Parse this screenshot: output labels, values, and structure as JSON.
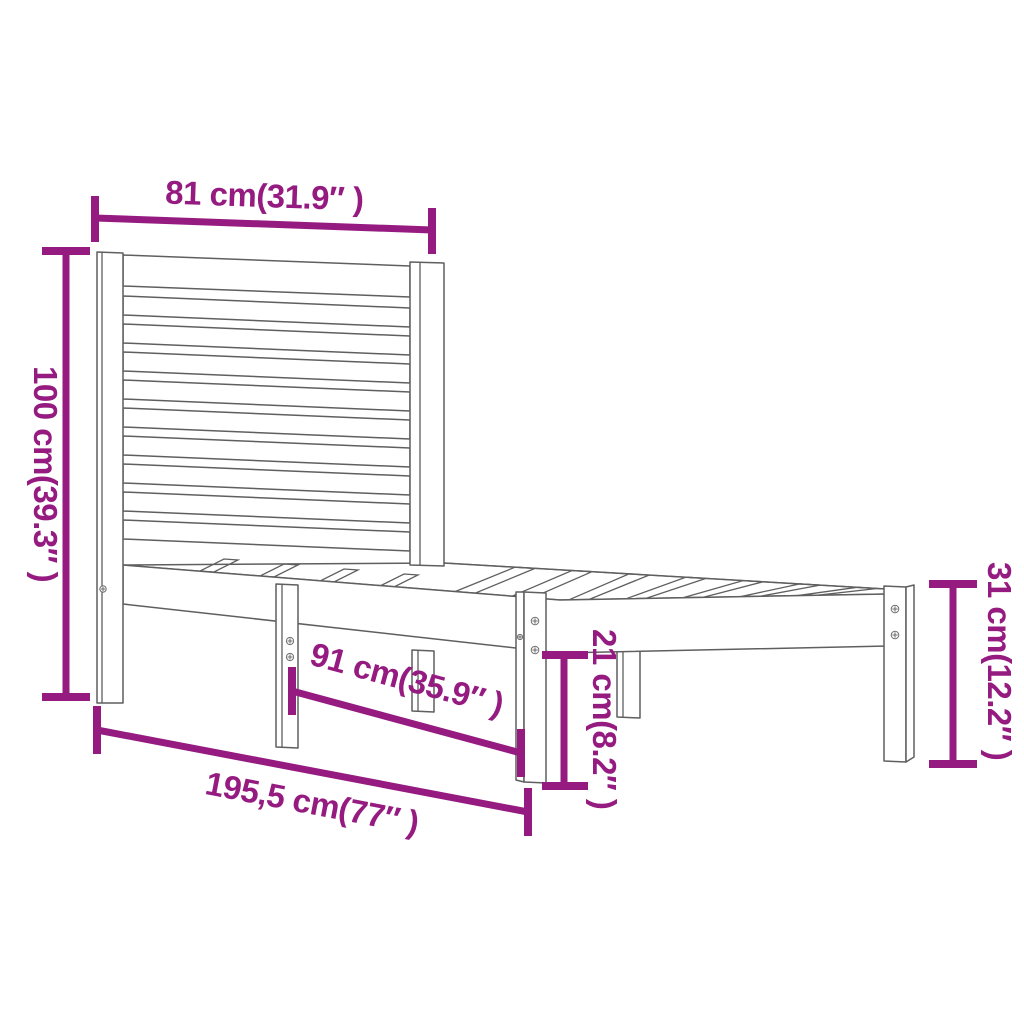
{
  "diagram": {
    "background_color": "#ffffff",
    "accent_color": "#951B81",
    "drawing_line_color": "#5f5f5f",
    "dimensions": {
      "headboard_width": {
        "label": "81 cm(31.9″ )",
        "cm": 81,
        "inches": 31.9
      },
      "headboard_height": {
        "label": "100 cm(39.3″ )",
        "cm": 100,
        "inches": 39.3
      },
      "underbed_length": {
        "label": "91 cm(35.9″ )",
        "cm": 91,
        "inches": 35.9
      },
      "total_length": {
        "label": "195,5 cm(77″ )",
        "cm": 195.5,
        "inches": 77
      },
      "underbed_height": {
        "label": "21 cm(8.2″ )",
        "cm": 21,
        "inches": 8.2
      },
      "frame_height": {
        "label": "31 cm(12.2″ )",
        "cm": 31,
        "inches": 12.2
      }
    }
  }
}
